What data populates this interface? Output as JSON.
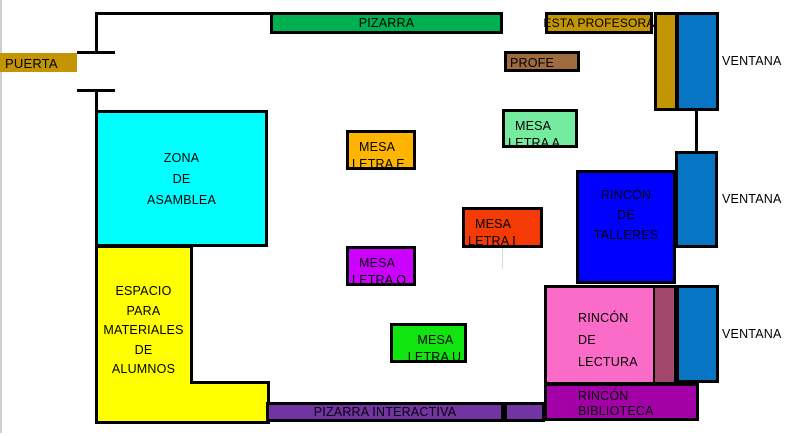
{
  "colors": {
    "gold": "#C49502",
    "board_green": "#00B050",
    "teacher_desk_brown": "#9E6B3E",
    "window_blue": "#0874C4",
    "assembly_cyan": "#00FFFF",
    "storage_yellow": "#FFFF00",
    "mesa_e_orange": "#FFB400",
    "mesa_a_mint": "#75EBA0",
    "mesa_i_red": "#F43A05",
    "mesa_o_magenta": "#CC00FF",
    "mesa_u_green": "#10E510",
    "talleres_blue": "#0000FF",
    "lectura_pink": "#FB6CC8",
    "lectura_strip_rose": "#A3476F",
    "biblioteca_magenta": "#A300A8",
    "pizarra_interactiva_purple": "#7233A3",
    "wall_black": "#000000"
  },
  "areas": {
    "puerta": {
      "label": "PUERTA"
    },
    "pizarra": {
      "label": "PIZARRA"
    },
    "esta_profesora": {
      "label": "ESTA PROFESORA"
    },
    "profe": {
      "label": "PROFE"
    },
    "ventana": {
      "label": "VENTANA"
    },
    "zona_asamblea": {
      "lines": [
        "ZONA",
        "DE",
        "ASAMBLEA"
      ]
    },
    "espacio_materiales": {
      "lines": [
        "ESPACIO",
        "PARA",
        "MATERIALES",
        "DE",
        "ALUMNOS"
      ]
    },
    "mesa_letra_e": {
      "lines": [
        "MESA",
        "LETRA E"
      ]
    },
    "mesa_letra_a": {
      "lines": [
        "MESA",
        "LETRA A"
      ]
    },
    "mesa_letra_i": {
      "lines": [
        "MESA",
        "LETRA I"
      ]
    },
    "mesa_letra_o": {
      "lines": [
        "MESA",
        "LETRA O"
      ]
    },
    "mesa_letra_u": {
      "lines": [
        "MESA",
        "LETRA U"
      ]
    },
    "rincon_talleres": {
      "lines": [
        "RINCÓN",
        "DE",
        "TALLERES"
      ]
    },
    "rincon_lectura": {
      "lines": [
        "RINCÓN",
        "DE",
        "LECTURA"
      ]
    },
    "rincon_biblioteca": {
      "lines": [
        "RINCÓN",
        "BIBLIOTECA"
      ]
    },
    "pizarra_interactiva": {
      "label": "PIZARRA INTERACTIVA"
    }
  }
}
